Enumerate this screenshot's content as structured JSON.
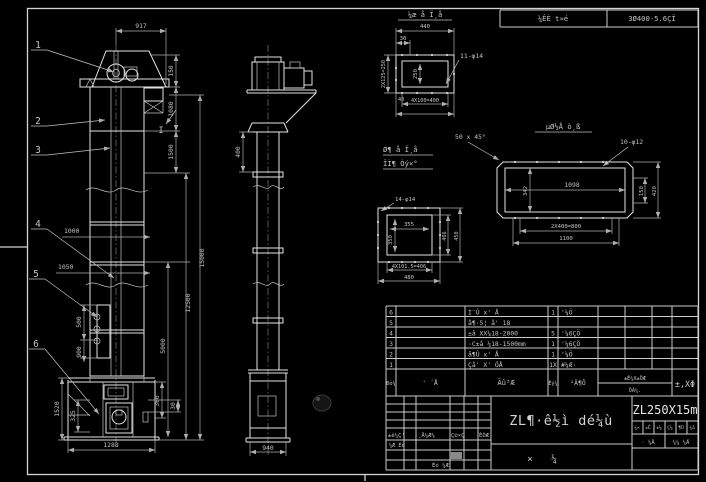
{
  "header_bar": {
    "cell1": "¼ÊÈ t»é",
    "cell2": "3Ø400-5.6ÇÏ"
  },
  "front_view": {
    "balloons": [
      "1",
      "2",
      "3",
      "4",
      "5",
      "6"
    ],
    "section_label": "I",
    "dims": {
      "top_width": "917",
      "head_h": "150",
      "upper_h": "1080",
      "neck_h": "1500",
      "left_a": "1000",
      "left_b": "1050",
      "pocket_h": "500",
      "pocket_b": "900",
      "total_h": "15000",
      "mid_h": "12500",
      "lower_h": "5000",
      "boot_h": "1520",
      "boot_inner": "325",
      "boot_right": "360",
      "boot_right_sm": "30",
      "base_w": "1288"
    }
  },
  "side_view": {
    "dims": {
      "neck": "400",
      "base_w": "940"
    }
  },
  "detail_discharge": {
    "title": "¼æ å Ï¸å",
    "dims": {
      "width": "440",
      "offset": "30",
      "holes": "11-φ14",
      "inner": "250",
      "left": "2X125=250",
      "small": "40",
      "pitch": "4X100=400"
    }
  },
  "detail_inlet": {
    "title1": "Ø¶ å Ï¸å",
    "title2": "ÏÌ¶ Òý×°",
    "dims": {
      "holes": "14-φ14",
      "inner_w": "355",
      "inner_h": "350",
      "right_in": "406",
      "right_out": "450",
      "pitch": "4X101.5=406",
      "width": "480"
    }
  },
  "detail_base": {
    "title": "µØ½Å ò¸ß",
    "chamfer": "50 x 45°",
    "holes": "10-φ12",
    "dims": {
      "inner_w": "1098",
      "inner_h": "342",
      "right_in": "150",
      "right_out": "420",
      "pitch": "2X400=800",
      "width": "1100"
    }
  },
  "parts_table": {
    "header": {
      "no": "Ðò¼",
      "dwg": "' ´Å",
      "name": "Ãû³Æ",
      "qty": "Êý¼",
      "mat": "²Ä¶Ô",
      "w1": "±Ê¼X±ÖÆ",
      "w2": "ÖÁ¼.",
      "note": "±,XΦ"
    },
    "rows": [
      {
        "no": "6",
        "name": "Ì¨Û x' Å",
        "qty": "1",
        "mat": "'¼Ö"
      },
      {
        "no": "5",
        "name": "å¶·5¦ å' 18",
        "qty": "",
        "mat": ""
      },
      {
        "no": "4",
        "name": "±å XX¼18-2000",
        "qty": "5",
        "mat": "'¼6ÇÖ"
      },
      {
        "no": "3",
        "name": "·C±å ¼18-1500mm",
        "qty": "1",
        "mat": "'¼6ÇÖ"
      },
      {
        "no": "2",
        "name": "å¶Û x' Å",
        "qty": "1",
        "mat": "'¼Ö"
      },
      {
        "no": "1",
        "name": "Çå' X' ÖÅ",
        "qty": "1X",
        "mat": "#¼Æ·"
      }
    ]
  },
  "title_block": {
    "model": "ZL250X15m",
    "drawing_title": "ZL¶·ê½ì dé¼ù",
    "type_a": "×",
    "type_b": "¼",
    "rev": {
      "c1": "±ê¼Ç'",
      "c2": "¸Ä¼Æ¼",
      "c3": "Ç©×Ç",
      "c4": "ÈÕÆ",
      "r1": "¼Æ Éè",
      "r2": "Éó ¼Æ"
    },
    "cells": [
      "¼×",
      "±Ê",
      "±¼",
      "Ç¼",
      "¶Ü",
      "¼ä"
    ],
    "sheet_a": "· ¼Ä",
    "sheet_b": "¼¼ ¼Ä"
  }
}
